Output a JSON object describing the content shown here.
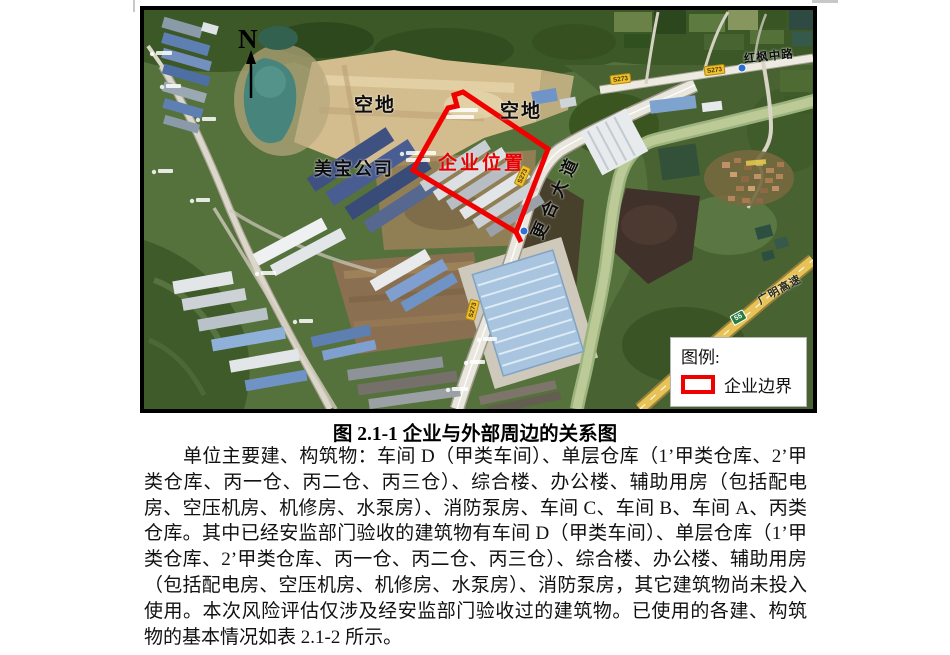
{
  "figure": {
    "caption": "图 2.1-1 企业与外部周边的关系图",
    "map": {
      "north_arrow": "N",
      "area_labels": {
        "vacant": "空地",
        "meibao_company": "美宝公司",
        "enterprise_location": "企业位置"
      },
      "road_labels": {
        "genghe_avenue": "更合大道",
        "hongfeng_middle_road": "红枫中路",
        "guangming_expressway": "广明高速",
        "s273_badge": "S273",
        "expressway_badge": "55"
      },
      "legend": {
        "title": "图例:",
        "boundary_label": "企业边界",
        "boundary_color": "#f10000"
      }
    }
  },
  "body": {
    "paragraph": "单位主要建、构筑物：车间 D（甲类车间）、单层仓库（1’甲类仓库、2’甲类仓库、丙一仓、丙二仓、丙三仓）、综合楼、办公楼、辅助用房（包括配电房、空压机房、机修房、水泵房）、消防泵房、车间 C、车间 B、车间 A、丙类仓库。其中已经安监部门验收的建筑物有车间 D（甲类车间）、单层仓库（1’甲类仓库、2’甲类仓库、丙一仓、丙二仓、丙三仓）、综合楼、办公楼、辅助用房（包括配电房、空压机房、机修房、水泵房）、消防泵房，其它建筑物尚未投入使用。本次风险评估仅涉及经安监部门验收过的建筑物。已使用的各建、构筑物的基本情况如表 2.1-2 所示。"
  }
}
